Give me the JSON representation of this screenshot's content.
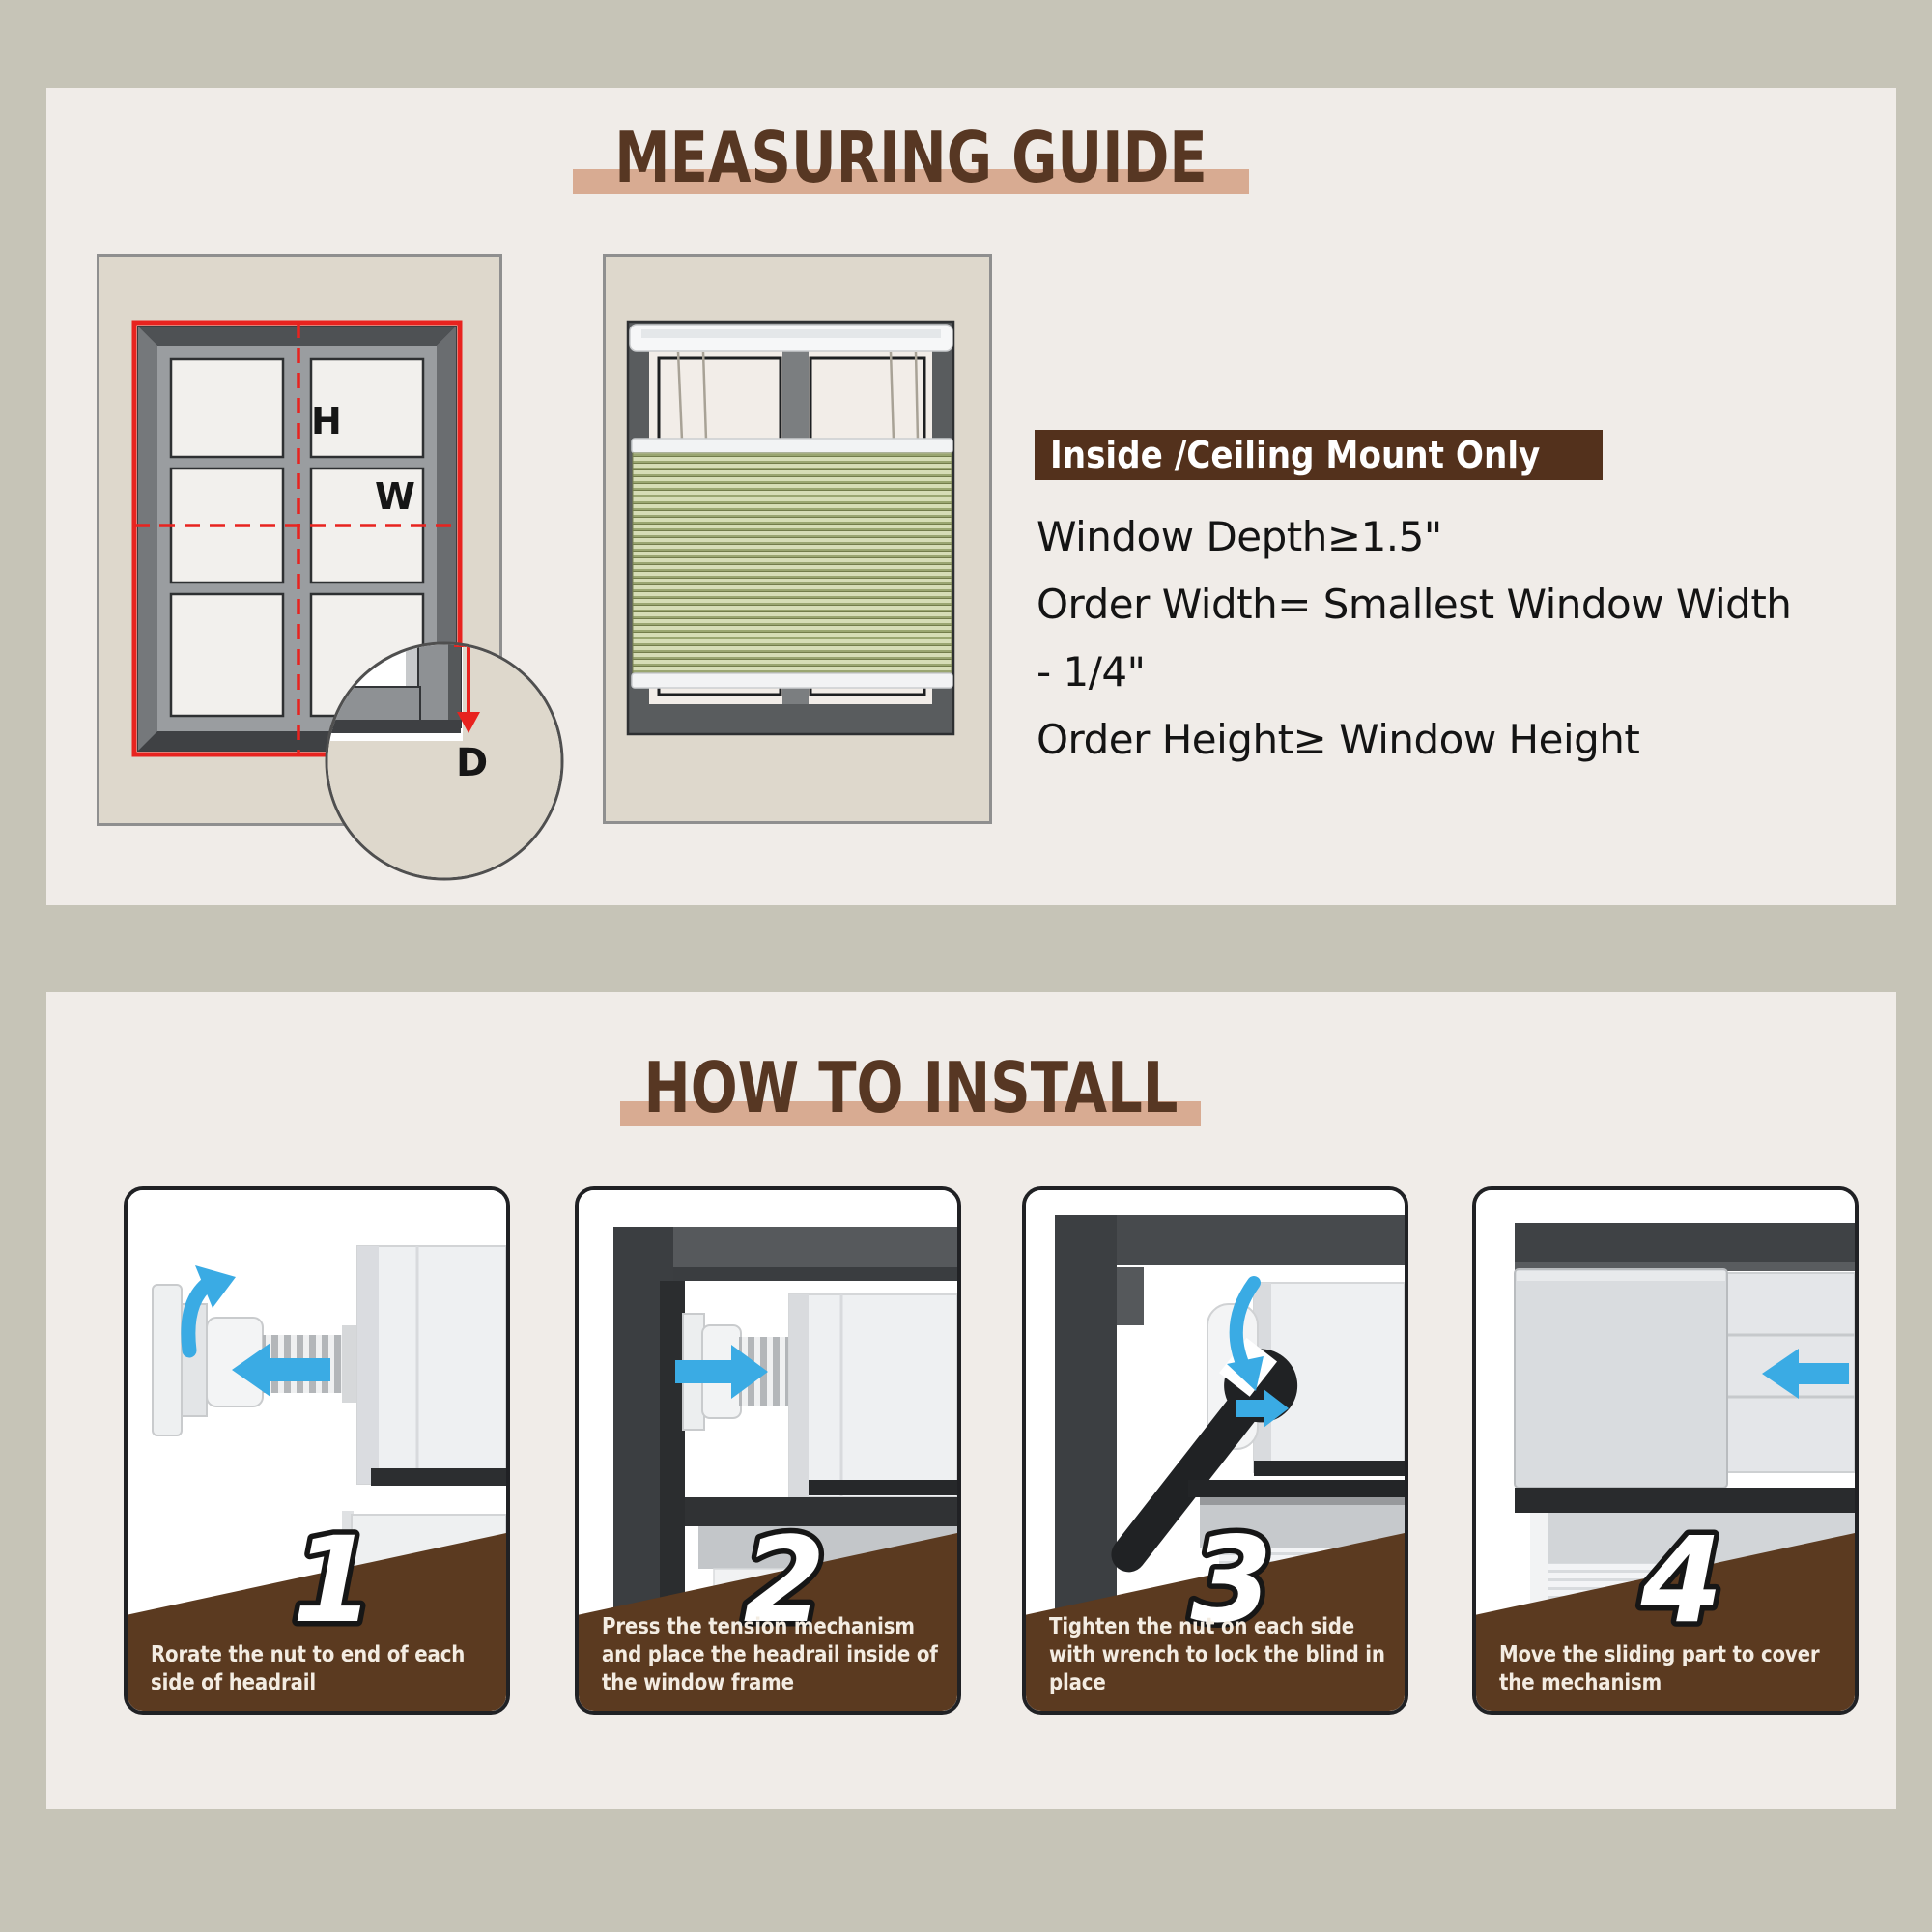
{
  "colors": {
    "page_bg": "#c6c4b7",
    "panel_bg": "#f0ece8",
    "title_brown": "#573723",
    "accent_bar_tan": "#d8ab92",
    "mount_box_bg": "#53311c",
    "step_footer_brown": "#5b3a20",
    "arrow_blue": "#3aabe4",
    "measure_red": "#e8231f",
    "wall_beige": "#ded8cc",
    "shade_green_light": "#d6ddb6",
    "shade_green_dark": "#9aa671"
  },
  "measuring_guide": {
    "title": "MEASURING GUIDE",
    "labels": {
      "h": "H",
      "w": "W",
      "d": "D"
    },
    "mount_box": "Inside /Ceiling Mount Only",
    "lines": [
      "Window Depth≥1.5\"",
      "Order Width= Smallest Window Width",
      "- 1/4\"",
      "Order Height≥ Window Height"
    ]
  },
  "how_to_install": {
    "title": "HOW TO INSTALL",
    "steps": [
      {
        "number": "1",
        "caption": "Rorate the nut to end of each side of headrail"
      },
      {
        "number": "2",
        "caption": "Press the tension mechanism and place the headrail inside of the window frame"
      },
      {
        "number": "3",
        "caption": "Tighten the nut on each side with wrench to lock the blind in place"
      },
      {
        "number": "4",
        "caption": "Move the sliding part to cover the mechanism"
      }
    ]
  }
}
